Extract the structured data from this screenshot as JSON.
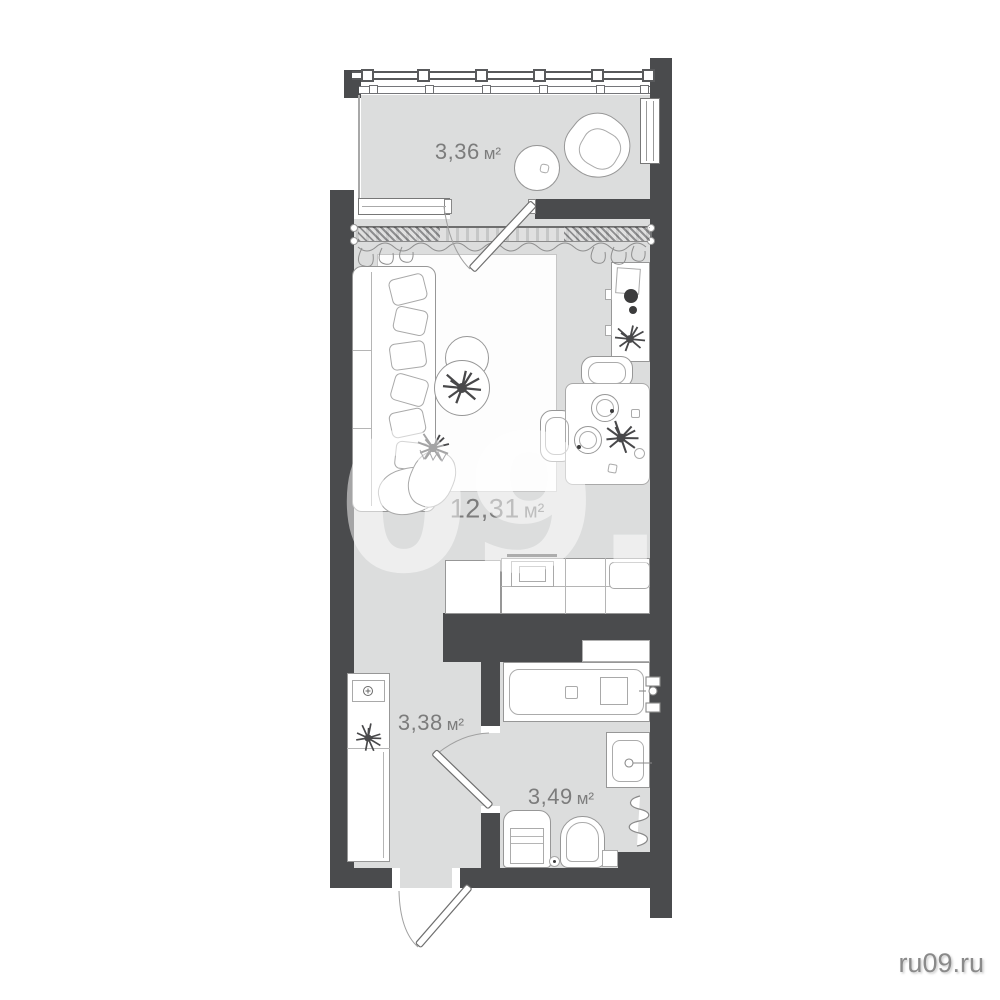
{
  "watermarks": {
    "large": "RU09.RU",
    "corner": "ru09.ru"
  },
  "rooms": [
    {
      "name": "balcony",
      "area": "3,36",
      "unit": "м²"
    },
    {
      "name": "living-room",
      "area": "12,31",
      "unit": "м²"
    },
    {
      "name": "hallway-kitchen",
      "area": "3,38",
      "unit": "м²"
    },
    {
      "name": "bathroom",
      "area": "3,49",
      "unit": "м²"
    }
  ],
  "colors": {
    "wall": "#4a4b4d",
    "floor": "#dcdddd",
    "outline": "#979797",
    "label": "#7c7c7c",
    "watermark": "rgba(255,255,255,0.5)",
    "corner_watermark": "#8a8a8a"
  },
  "fixtures": [
    "balcony-glazing",
    "balcony-table",
    "balcony-chair",
    "side-window",
    "window-sill",
    "balcony-door",
    "curtain",
    "sofa",
    "pillow",
    "blanket",
    "rug",
    "coffee-table",
    "plant",
    "desk",
    "turntable",
    "dining-table",
    "dining-chair",
    "plate",
    "kitchen-counter",
    "stove",
    "kitchen-sink",
    "wardrobe",
    "electric-panel",
    "entrance-door",
    "bathroom-door",
    "bathtub",
    "niche",
    "washbasin",
    "towel-dryer",
    "washing-machine",
    "toilet",
    "toilet-brush"
  ]
}
